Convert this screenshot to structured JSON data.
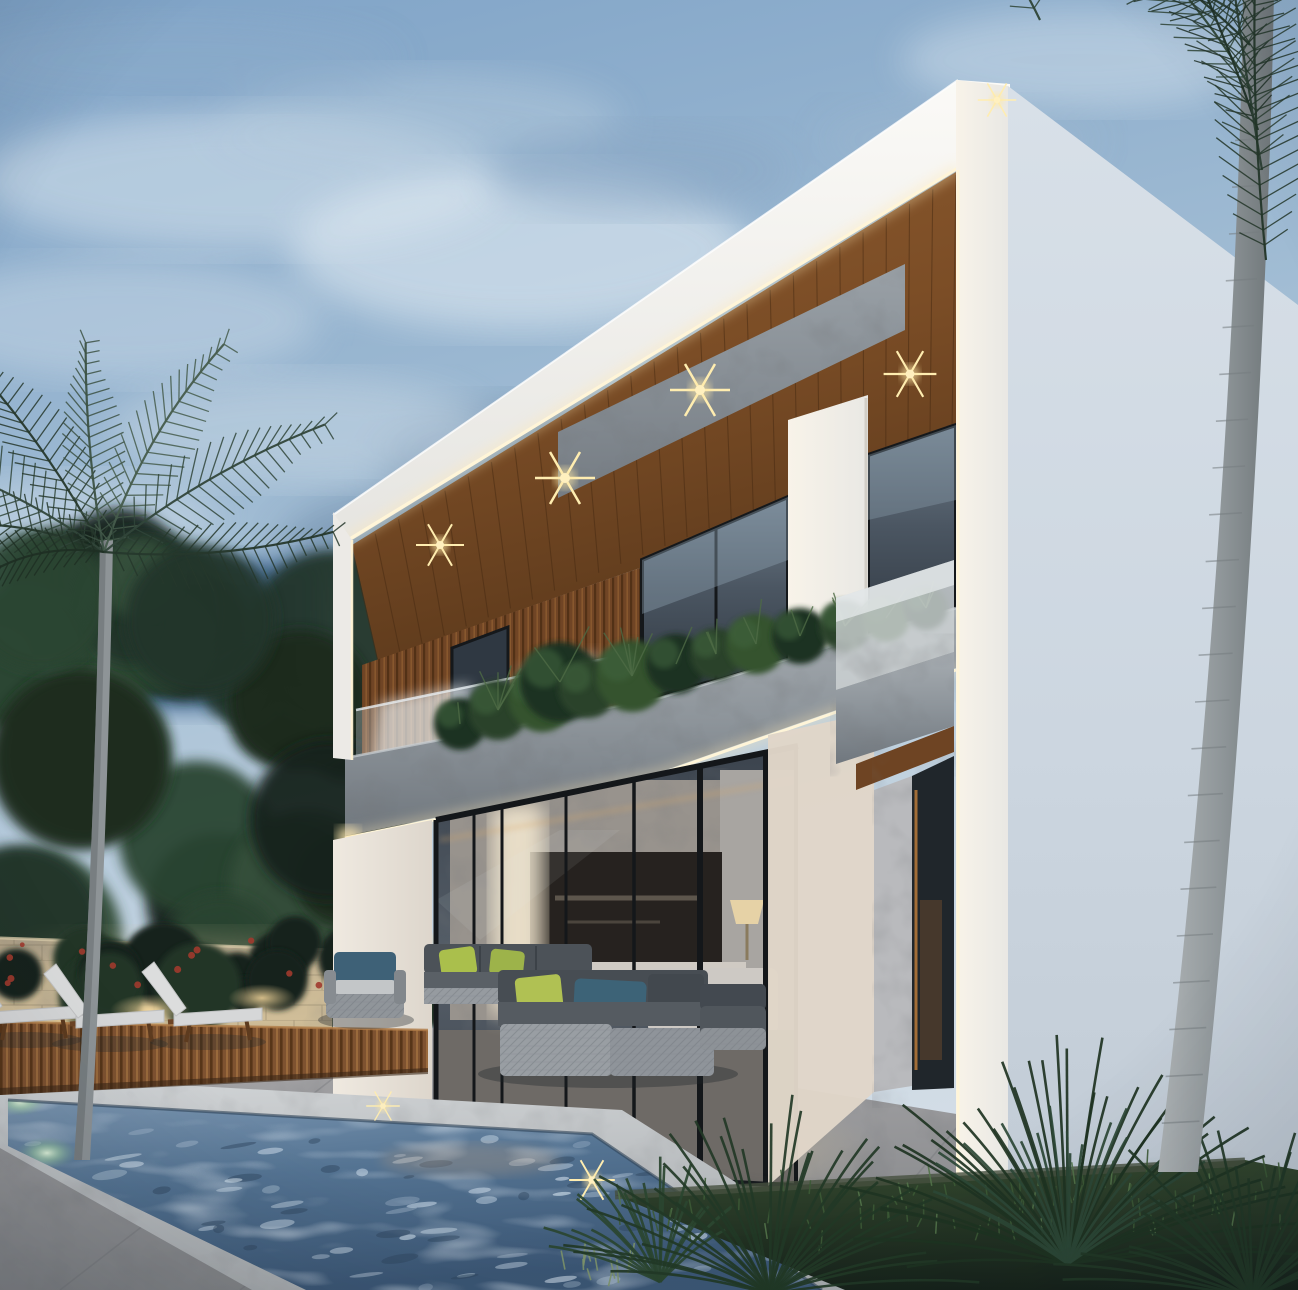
{
  "scene": {
    "type": "architectural_render",
    "title": "Modern two-story luxury villa exterior at dusk with pool, wood deck and palm trees",
    "time_of_day": "dusk",
    "weather": "partly cloudy"
  },
  "palette": {
    "sky_top": "#7fa3c7",
    "sky_mid": "#a6c0d6",
    "sky_low": "#ccd9e3",
    "cloud_light": "#e9f1f6",
    "cloud_shadow": "#6f8dac",
    "deep_sky_patch": "#4c7096",
    "foliage_dark": "#1f2d22",
    "foliage_mid": "#2e4430",
    "palm_green": "#3a5240",
    "palm_dark": "#22332a",
    "trunk_gray": "#9aa1a4",
    "perimeter_wall": "#a99b82",
    "perimeter_wall_lit": "#d9c7a4",
    "building_white": "#f3f1ed",
    "building_white_shade": "#e4e4e2",
    "building_pale_plane": "#ccd6e0",
    "wood_slat": "#8a5530",
    "wood_slat_dark": "#5f3a1d",
    "wood_ceiling": "#7b4d27",
    "stone_band": "#8e959b",
    "glass_dark": "#39424e",
    "glass_reflection": "#97a6b2",
    "led_warm": "#fff2cf",
    "downlight": "#ffe9a6",
    "pool_coping": "#c7cacc",
    "water_deep": "#3c5874",
    "water_mid": "#61809f",
    "water_light": "#a8c0d4",
    "pool_light_glow": "#c9ecc9",
    "deck_wood": "#8a5c36",
    "patio_stone": "#9b9da1",
    "cushion_light": "#d9dadb",
    "cushion_charcoal": "#474c52",
    "pillow_lime": "#a9bf4e",
    "pillow_teal": "#3f6478",
    "lawn_green": "#2a3b28"
  },
  "building": {
    "floors": 2,
    "materials": [
      "white plaster",
      "teak wood slats",
      "gray stone cladding",
      "floor-to-ceiling glass"
    ],
    "lighting": {
      "soffit_downlight_count": 5,
      "led_strip_count": 3,
      "led_strips": [
        "roof fascia underside",
        "planter band underside",
        "right corner vertical"
      ]
    },
    "features": [
      "cantilevered upper floor",
      "glass balcony railing",
      "stone planter with shrubs",
      "small side balcony",
      "recessed entry with warm light"
    ]
  },
  "landscape": {
    "left": [
      "tall palm tree",
      "dense evergreen trees",
      "stone perimeter wall with uplights",
      "flowering shrubs"
    ],
    "right": [
      "royal palm trunk",
      "cycad plants",
      "lawn grass"
    ],
    "foreground": [
      "raised swimming pool",
      "wood pool deck",
      "stone patio"
    ]
  },
  "pool": {
    "underwater_light_count": 6,
    "surface_sparkle_count": 2
  },
  "furniture": {
    "sun_loungers": 3,
    "outdoor_sofas": 2,
    "armchairs": 2,
    "accent_pillow_colors": [
      "#a9bf4e",
      "#3f6478"
    ]
  },
  "interior": {
    "visible_items": [
      "wall-mounted tv",
      "media console",
      "table lamp",
      "white sofa",
      "marble feature wall"
    ]
  }
}
